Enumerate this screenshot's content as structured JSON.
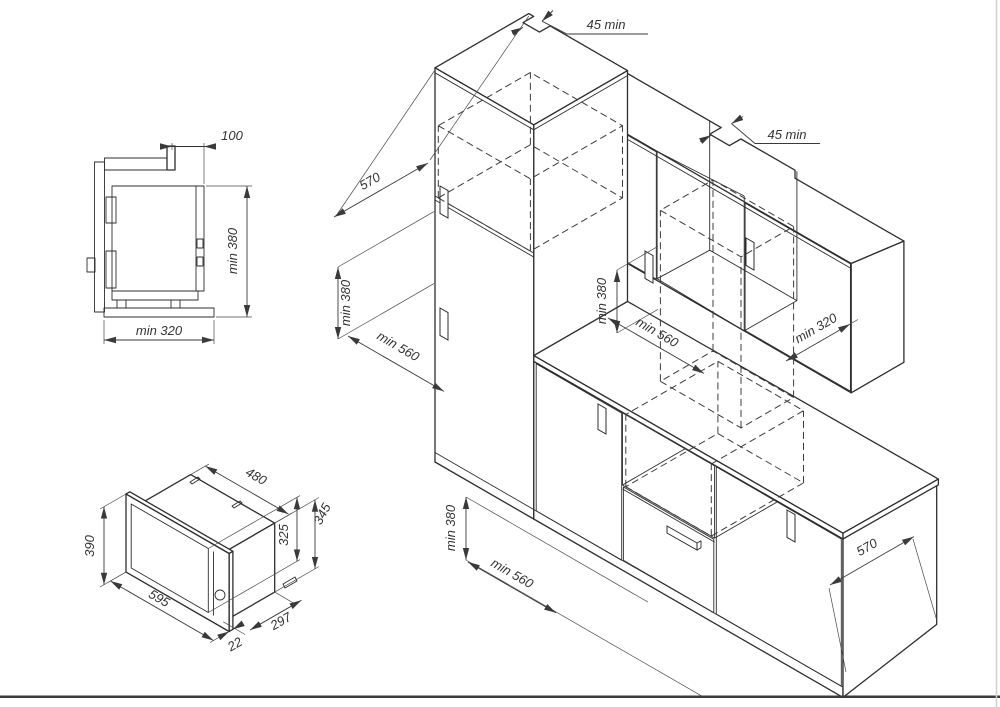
{
  "page": {
    "background": "#ffffff",
    "line_color": "#2e2e2e"
  },
  "side_view": {
    "dims": {
      "top_offset": "100",
      "height": "min 380",
      "width": "min 320"
    }
  },
  "iso_view": {
    "dims": {
      "body_width": "480",
      "body_height": "345",
      "door_height": "325",
      "frame_height": "390",
      "frame_width": "595",
      "body_depth": "297",
      "frame_thickness": "22"
    }
  },
  "kitchen_view": {
    "dims": {
      "vent_gap_top": "45 min",
      "vent_gap_right": "45 min",
      "tall_depth": "570",
      "tall_niche_height": "min 380",
      "tall_niche_width": "min 560",
      "wall_niche_height": "min 380",
      "wall_niche_width": "min 560",
      "wall_niche_depth": "min 320",
      "base_niche_height": "min 380",
      "base_niche_width": "min 560",
      "base_depth": "570"
    }
  }
}
